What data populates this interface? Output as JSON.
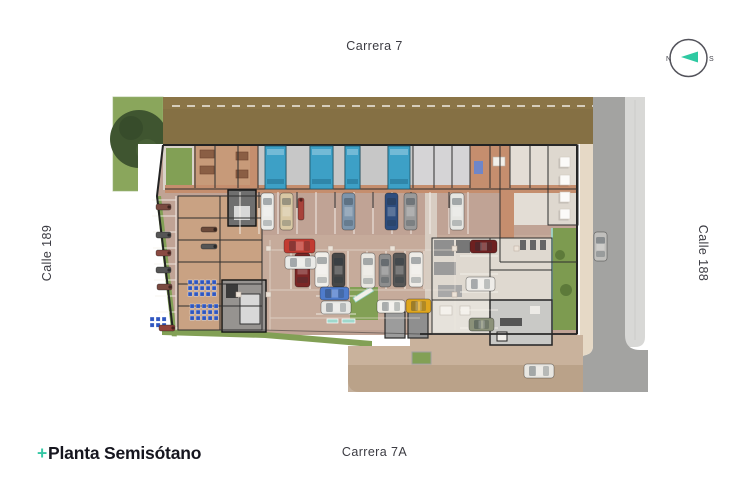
{
  "labels": {
    "street_top": "Carrera 7",
    "street_bottom": "Carrera 7A",
    "street_left": "Calle 189",
    "street_right": "Calle 188",
    "title_prefix": "+",
    "title": "Planta Semisótano"
  },
  "compass": {
    "north": "N",
    "south": "S",
    "arrow_color": "#2ec9a2",
    "ring_color": "#53535b"
  },
  "palette": {
    "background": "#ffffff",
    "earth": "#857044",
    "grass": "#82a055",
    "tree": "#3f5530",
    "road": "#a3a3a1",
    "cobble_sidewalk": "#d8d8d6",
    "curb_sidewalk": "#e6d9c6",
    "parking_floor": "#c0a395",
    "aisle_floor": "#c9b0a0",
    "corridor": "#c58e6e",
    "storage_floor": "#c9a283",
    "room_gray": "#c7c7c7",
    "room_light": "#e3ddd5",
    "plaza": "#c9b29c",
    "plaza_dark": "#b79d85",
    "water": "#3da0c6",
    "bike_rack": "#2f56c0",
    "wall": "#232323",
    "marking": "#f6f2ec",
    "label_text": "#3b3b42",
    "title_text": "#16161f",
    "accent_teal": "#35c8a5"
  },
  "plan": {
    "water_tanks": [
      {
        "x": 265,
        "y": 146,
        "w": 21,
        "h": 43
      },
      {
        "x": 310,
        "y": 146,
        "w": 23,
        "h": 43
      },
      {
        "x": 345,
        "y": 146,
        "w": 15,
        "h": 43
      },
      {
        "x": 388,
        "y": 146,
        "w": 22,
        "h": 43
      }
    ],
    "vehicles": [
      {
        "x": 261,
        "y": 193,
        "w": 13,
        "h": 37,
        "color": "#ebebe8",
        "type": "car"
      },
      {
        "x": 280,
        "y": 193,
        "w": 13,
        "h": 37,
        "color": "#d9c8a4",
        "type": "car"
      },
      {
        "x": 298,
        "y": 198,
        "w": 6,
        "h": 22,
        "color": "#a8423a",
        "type": "moto"
      },
      {
        "x": 342,
        "y": 193,
        "w": 13,
        "h": 37,
        "color": "#7e95ab",
        "type": "car"
      },
      {
        "x": 385,
        "y": 193,
        "w": 13,
        "h": 37,
        "color": "#2e4d7e",
        "type": "car"
      },
      {
        "x": 404,
        "y": 193,
        "w": 13,
        "h": 37,
        "color": "#9a9a9a",
        "type": "car"
      },
      {
        "x": 450,
        "y": 193,
        "w": 14,
        "h": 37,
        "color": "#e6e6e2",
        "type": "car"
      },
      {
        "x": 295,
        "y": 253,
        "w": 15,
        "h": 34,
        "color": "#7c2626",
        "type": "car"
      },
      {
        "x": 315,
        "y": 252,
        "w": 14,
        "h": 35,
        "color": "#f0eee9",
        "type": "car"
      },
      {
        "x": 332,
        "y": 253,
        "w": 13,
        "h": 34,
        "color": "#474747",
        "type": "car"
      },
      {
        "x": 361,
        "y": 253,
        "w": 14,
        "h": 35,
        "color": "#e9e7e1",
        "type": "car"
      },
      {
        "x": 379,
        "y": 254,
        "w": 12,
        "h": 33,
        "color": "#8d8d8d",
        "type": "car"
      },
      {
        "x": 393,
        "y": 253,
        "w": 13,
        "h": 34,
        "color": "#565656",
        "type": "car"
      },
      {
        "x": 409,
        "y": 252,
        "w": 14,
        "h": 35,
        "color": "#efece7",
        "type": "car"
      },
      {
        "x": 320,
        "y": 287,
        "w": 29,
        "h": 13,
        "color": "#4f7ccc",
        "type": "car"
      },
      {
        "x": 321,
        "y": 301,
        "w": 30,
        "h": 13,
        "color": "#e7e7e4",
        "type": "car"
      },
      {
        "x": 377,
        "y": 300,
        "w": 28,
        "h": 13,
        "color": "#f1efe9",
        "type": "car"
      },
      {
        "x": 406,
        "y": 299,
        "w": 25,
        "h": 14,
        "color": "#dfa61e",
        "type": "car"
      },
      {
        "x": 470,
        "y": 240,
        "w": 27,
        "h": 13,
        "color": "#6e2020",
        "type": "car"
      },
      {
        "x": 466,
        "y": 277,
        "w": 29,
        "h": 14,
        "color": "#eeece8",
        "type": "car"
      },
      {
        "x": 469,
        "y": 318,
        "w": 25,
        "h": 13,
        "color": "#8b9179",
        "type": "car"
      },
      {
        "x": 284,
        "y": 239,
        "w": 31,
        "h": 14,
        "color": "#c23b31",
        "type": "car"
      },
      {
        "x": 285,
        "y": 256,
        "w": 31,
        "h": 13,
        "color": "#e9e9e6",
        "type": "car"
      },
      {
        "x": 594,
        "y": 232,
        "w": 13,
        "h": 29,
        "color": "#c0bfbc",
        "type": "car"
      },
      {
        "x": 524,
        "y": 364,
        "w": 30,
        "h": 14,
        "color": "#e8e6e1",
        "type": "car"
      },
      {
        "x": 156,
        "y": 204,
        "w": 15,
        "h": 6,
        "color": "#7a4a40",
        "type": "moto"
      },
      {
        "x": 156,
        "y": 232,
        "w": 15,
        "h": 6,
        "color": "#555555",
        "type": "moto"
      },
      {
        "x": 156,
        "y": 250,
        "w": 15,
        "h": 6,
        "color": "#8a4a42",
        "type": "moto"
      },
      {
        "x": 156,
        "y": 267,
        "w": 15,
        "h": 6,
        "color": "#555555",
        "type": "moto"
      },
      {
        "x": 157,
        "y": 284,
        "w": 15,
        "h": 6,
        "color": "#7a4a40",
        "type": "moto"
      },
      {
        "x": 159,
        "y": 325,
        "w": 16,
        "h": 6,
        "color": "#90423a",
        "type": "moto"
      },
      {
        "x": 201,
        "y": 227,
        "w": 16,
        "h": 5,
        "color": "#6b4a3a",
        "type": "moto"
      },
      {
        "x": 201,
        "y": 244,
        "w": 16,
        "h": 5,
        "color": "#555555",
        "type": "moto"
      }
    ],
    "tables": [
      {
        "x": 560,
        "y": 157
      },
      {
        "x": 560,
        "y": 175
      },
      {
        "x": 560,
        "y": 192
      },
      {
        "x": 560,
        "y": 209
      }
    ],
    "bike_racks": [
      {
        "x": 188,
        "y": 280,
        "cols": 5,
        "rows": 3
      },
      {
        "x": 190,
        "y": 304,
        "cols": 5,
        "rows": 3
      },
      {
        "x": 150,
        "y": 317,
        "cols": 3,
        "rows": 2
      }
    ],
    "columns": [
      {
        "x": 266,
        "y": 246
      },
      {
        "x": 328,
        "y": 246
      },
      {
        "x": 390,
        "y": 246
      },
      {
        "x": 452,
        "y": 246
      },
      {
        "x": 514,
        "y": 246
      },
      {
        "x": 266,
        "y": 292
      },
      {
        "x": 452,
        "y": 292
      },
      {
        "x": 236,
        "y": 292
      }
    ],
    "speed_bumps": [
      {
        "x": 327,
        "y": 319,
        "w": 11,
        "h": 4
      },
      {
        "x": 342,
        "y": 319,
        "w": 13,
        "h": 4
      }
    ]
  }
}
